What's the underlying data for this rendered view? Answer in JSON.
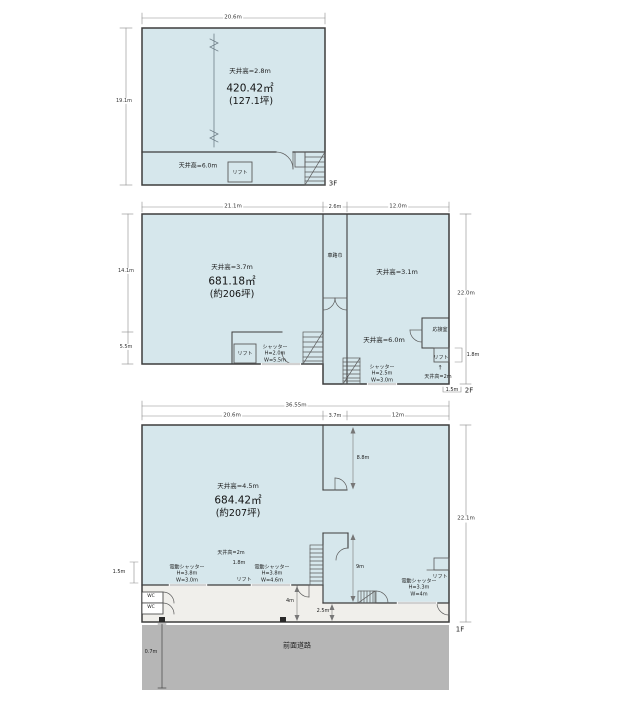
{
  "colors": {
    "floor_fill": "#d6e7ec",
    "entrance_fill": "#f0efeb",
    "road_fill": "#b6b6b6",
    "wall": "#3d3d3d"
  },
  "f3": {
    "floor_tag": "3F",
    "dim_top": "20.6m",
    "dim_left": "19.1m",
    "ceiling_main": "天井高=2.8m",
    "area_sqm": "420.42㎡",
    "area_tsubo": "(127.1坪)",
    "ceiling_low": "天井高=6.0m",
    "lift": "リフト"
  },
  "f2": {
    "floor_tag": "2F",
    "dim_top_left": "21.1m",
    "dim_top_mid": "2.6m",
    "dim_top_right": "12.0m",
    "dim_left_upper": "14.1m",
    "dim_left_lower": "5.5m",
    "dim_right": "22.0m",
    "dim_lift": "1.8m",
    "dim_bottom": "1.5m",
    "ceiling_main": "天井高=3.7m",
    "area_sqm": "681.18㎡",
    "area_tsubo": "(約206坪)",
    "ramp_label": "車路巾",
    "ceiling_right": "天井高=3.1m",
    "ceiling_right_low": "天井高=6.0m",
    "reception": "応接室",
    "lift_left": "リフト",
    "shutter_left": "シャッター\nH=2.0m\nW=5.5m",
    "lift_right": "リフト",
    "lift_arrow": "↑",
    "ceiling_lift": "天井高=2m",
    "shutter_right": "シャッター\nH=2.5m\nW=3.0m"
  },
  "f1": {
    "floor_tag": "1F",
    "dim_top_total": "36.55m",
    "dim_top_left": "20.6m",
    "dim_top_mid": "3.7m",
    "dim_top_right": "12m",
    "dim_right": "22.1m",
    "dim_left": "1.5m",
    "ceiling_main": "天井高=4.5m",
    "area_sqm": "684.42㎡",
    "area_tsubo": "(約207坪)",
    "dim_ramp": "8.8m",
    "dim_shaft": "9m",
    "ceiling_lift": "天井高=2m",
    "dim_lift_opening": "1.8m",
    "lift_center": "リフト",
    "shutter_left": "電動シャッター\nH=3.8m\nW=3.0m",
    "shutter_mid": "電動シャッター\nH=3.8m\nW=4.6m",
    "shutter_right": "電動シャッター\nH=3.3m\nW=4m",
    "lift_right": "リフト",
    "wc_upper": "WC",
    "wc_lower": "WC",
    "dim_entrance_left": "4m",
    "dim_entrance_right": "2.5m",
    "dim_road": "0.7m",
    "road_label": "前面道路"
  }
}
